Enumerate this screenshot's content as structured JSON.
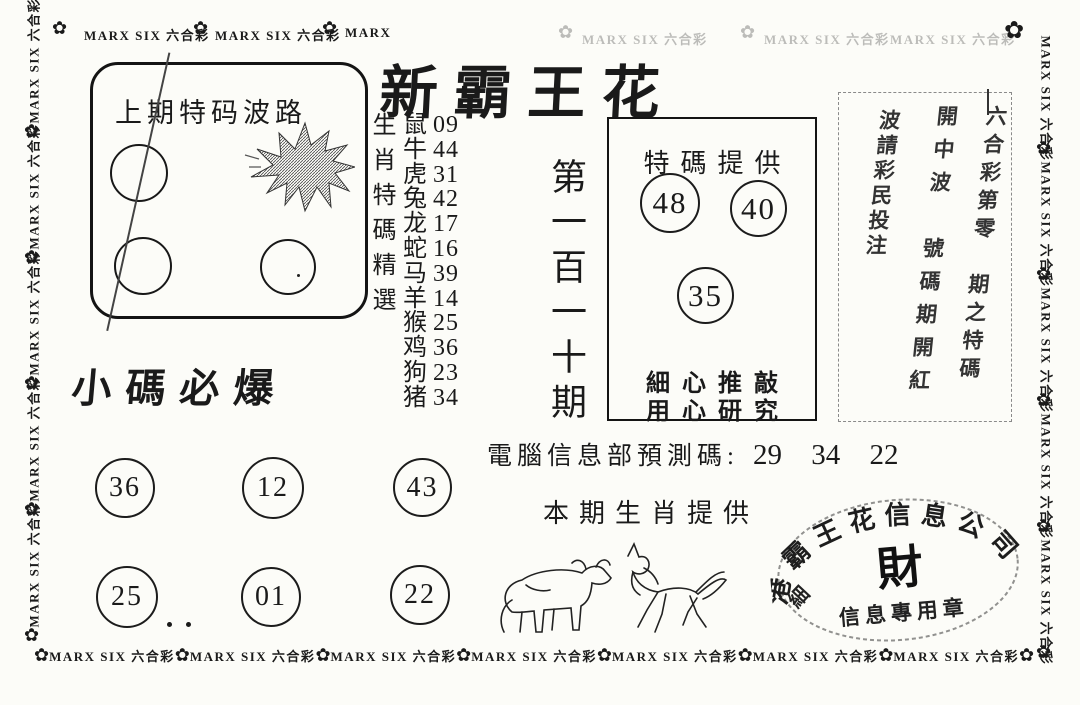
{
  "page_bg": "#fcfcf8",
  "ink": "#1a1a1a",
  "border": {
    "brand_label": "MARX SIX 六合彩",
    "brand_short": "MARX",
    "flower_glyph": "✿"
  },
  "title": "新霸王花",
  "prev_box": {
    "title": "上期特码波路"
  },
  "selection_heading": "生肖特碼精選",
  "zodiac": {
    "rows": [
      {
        "animal": "鼠",
        "num": "09"
      },
      {
        "animal": "牛",
        "num": "44"
      },
      {
        "animal": "虎",
        "num": "31"
      },
      {
        "animal": "兔",
        "num": "42"
      },
      {
        "animal": "龙",
        "num": "17"
      },
      {
        "animal": "蛇",
        "num": "16"
      },
      {
        "animal": "马",
        "num": "39"
      },
      {
        "animal": "羊",
        "num": "14"
      },
      {
        "animal": "猴",
        "num": "25"
      },
      {
        "animal": "鸡",
        "num": "36"
      },
      {
        "animal": "狗",
        "num": "23"
      },
      {
        "animal": "猪",
        "num": "34"
      }
    ]
  },
  "issue_label": "第一百一十期",
  "special_box": {
    "title": "特碼提供",
    "num1": "48",
    "num2": "40",
    "num3": "35",
    "note1": "細心推敲",
    "note2": "用心研究"
  },
  "handwritten_box": {
    "col1": "六合彩第零　期之特碼",
    "col2": "開中波　號碼期開紅",
    "col3": "波請彩民投注"
  },
  "prediction": {
    "label": "電腦信息部預測碼:",
    "numbers": "29 34 22"
  },
  "small_codes": {
    "heading": "小碼必爆",
    "c1": "36",
    "c2": "12",
    "c3": "43",
    "c4": "25",
    "c5": "01",
    "c6": "22"
  },
  "this_issue": {
    "heading": "本期生肖提供",
    "animals": [
      "ox",
      "horse"
    ]
  },
  "stamp": {
    "arc_text": "港霸王花信息公司",
    "center_char": "財",
    "bottom_text": "信息專用章",
    "side_char": "細"
  }
}
